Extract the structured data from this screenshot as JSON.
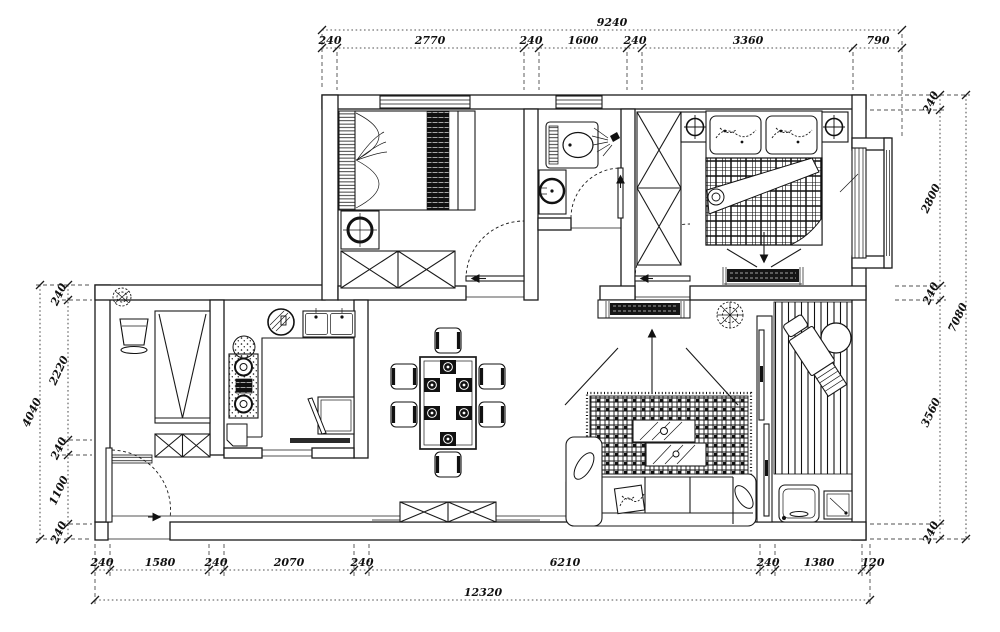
{
  "drawing": {
    "kind": "apartment-floor-plan",
    "background": "#ffffff",
    "line_color": "#1a1a1a"
  },
  "dimensions": {
    "top": {
      "overall": "9240",
      "segments": [
        "240",
        "2770",
        "240",
        "1600",
        "240",
        "3360",
        "790"
      ]
    },
    "bottom": {
      "overall": "12320",
      "segments": [
        "240",
        "1580",
        "240",
        "2070",
        "240",
        "6210",
        "240",
        "1380",
        "120"
      ]
    },
    "left": {
      "overall": "4040",
      "segments": [
        "240",
        "2220",
        "240",
        "1100",
        "240"
      ]
    },
    "right": {
      "overall": "7080",
      "segments": [
        "240",
        "2800",
        "240",
        "3560",
        "240"
      ]
    }
  }
}
